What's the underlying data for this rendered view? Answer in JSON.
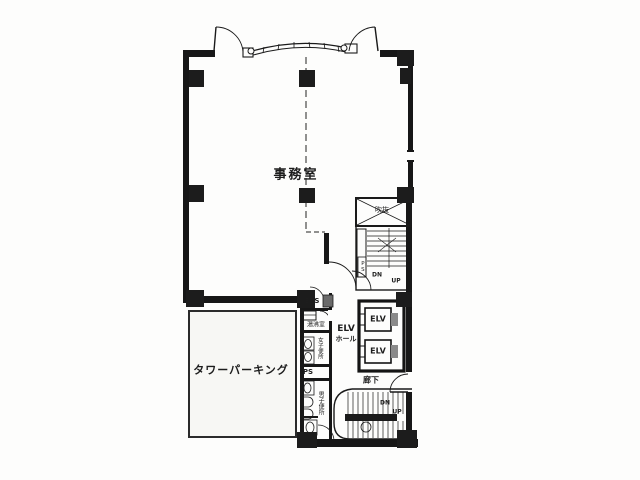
{
  "colors": {
    "line": "#1a1a1a",
    "background": "#ffffff"
  },
  "labels": {
    "office": "事務室",
    "parking": "タワーパーキング",
    "elevator_hall": {
      "line1": "ELV",
      "line2": "ホール"
    },
    "elevator_1": "ELV",
    "elevator_2": "ELV",
    "corridor": "廊下",
    "void_space": "吹抜",
    "eps": "EPS",
    "kitchenette": "湯沸室",
    "womens_toilet": "女子便所",
    "pipe_shaft": "PS",
    "stair_shaft": "PS",
    "mens_toilet": "男子便所",
    "stair_upper": {
      "down": "DN",
      "up": "UP"
    },
    "stair_lower": {
      "down": "DN",
      "up": "UP"
    }
  }
}
